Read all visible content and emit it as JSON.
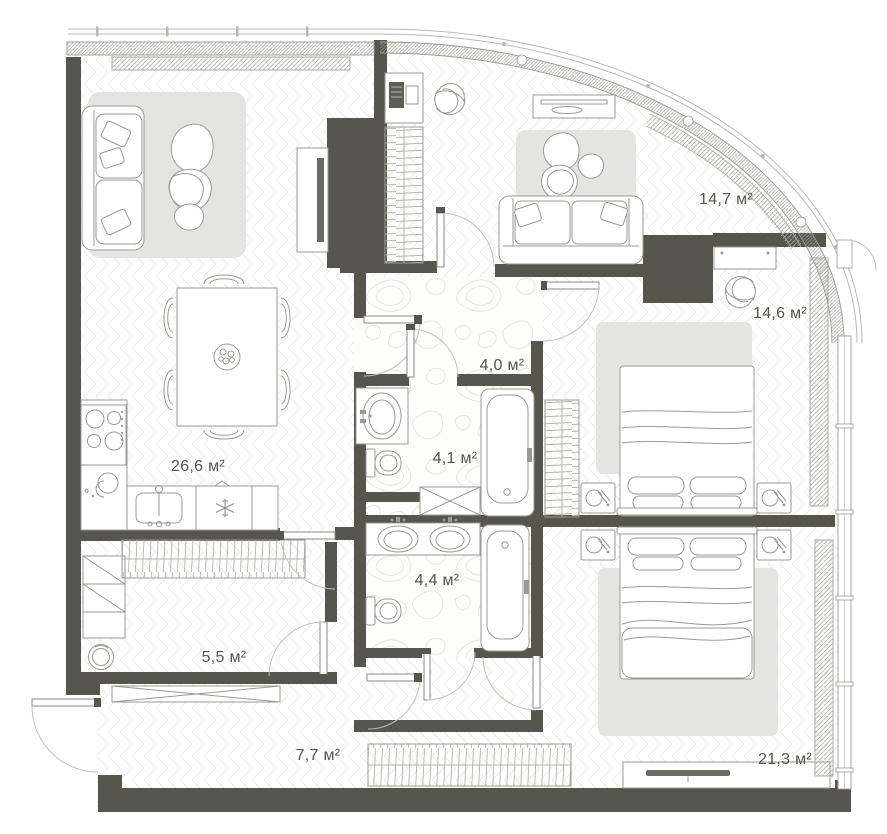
{
  "plan": {
    "kind": "apartment-floor-plan",
    "units": "м²"
  },
  "rooms": [
    {
      "id": "living-kitchen",
      "area_label": "26,6 м²"
    },
    {
      "id": "lounge-study",
      "area_label": "14,7 м²"
    },
    {
      "id": "bedroom-2",
      "area_label": "14,6 м²"
    },
    {
      "id": "corridor",
      "area_label": "4,0 м²"
    },
    {
      "id": "bathroom-1",
      "area_label": "4,1 м²"
    },
    {
      "id": "bathroom-2",
      "area_label": "4,4 м²"
    },
    {
      "id": "dressing-laundry",
      "area_label": "5,5 м²"
    },
    {
      "id": "hallway",
      "area_label": "7,7 м²"
    },
    {
      "id": "bedroom-master",
      "area_label": "21,3 м²"
    }
  ],
  "colors": {
    "wall": "#56564c",
    "floor_pattern_line": "#eaeae7",
    "stone_pattern_line": "#e7e5e0",
    "rug": "#e4e4e2",
    "furniture_line": "#9a9a94",
    "window_line": "#9a9a95",
    "railing_line": "#b9b9b4",
    "door_arc": "#c2c2bd",
    "label_text": "#55554e",
    "background": "#ffffff"
  }
}
